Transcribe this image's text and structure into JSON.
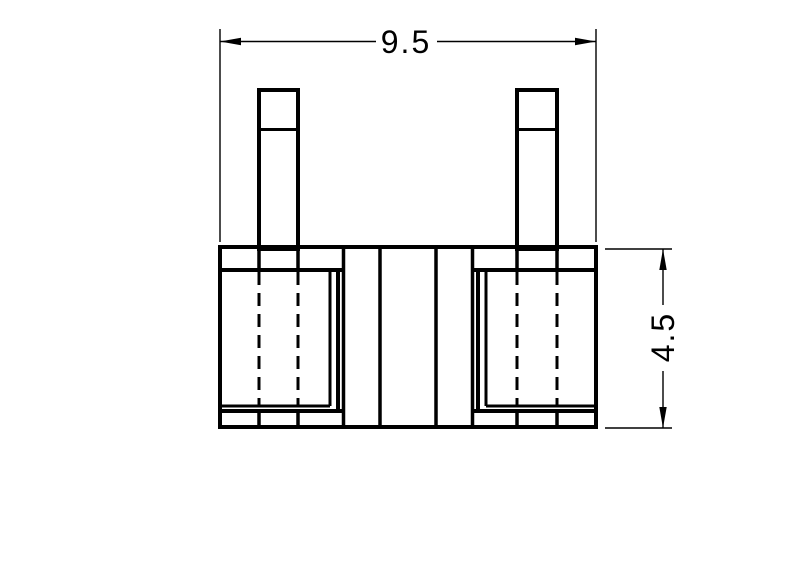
{
  "drawing": {
    "background_color": "#ffffff",
    "line_color": "#000000",
    "dimensions": {
      "width": {
        "label": "9.5",
        "orientation": "horizontal",
        "position": "top"
      },
      "height": {
        "label": "4.5",
        "orientation": "vertical",
        "position": "right"
      }
    }
  }
}
